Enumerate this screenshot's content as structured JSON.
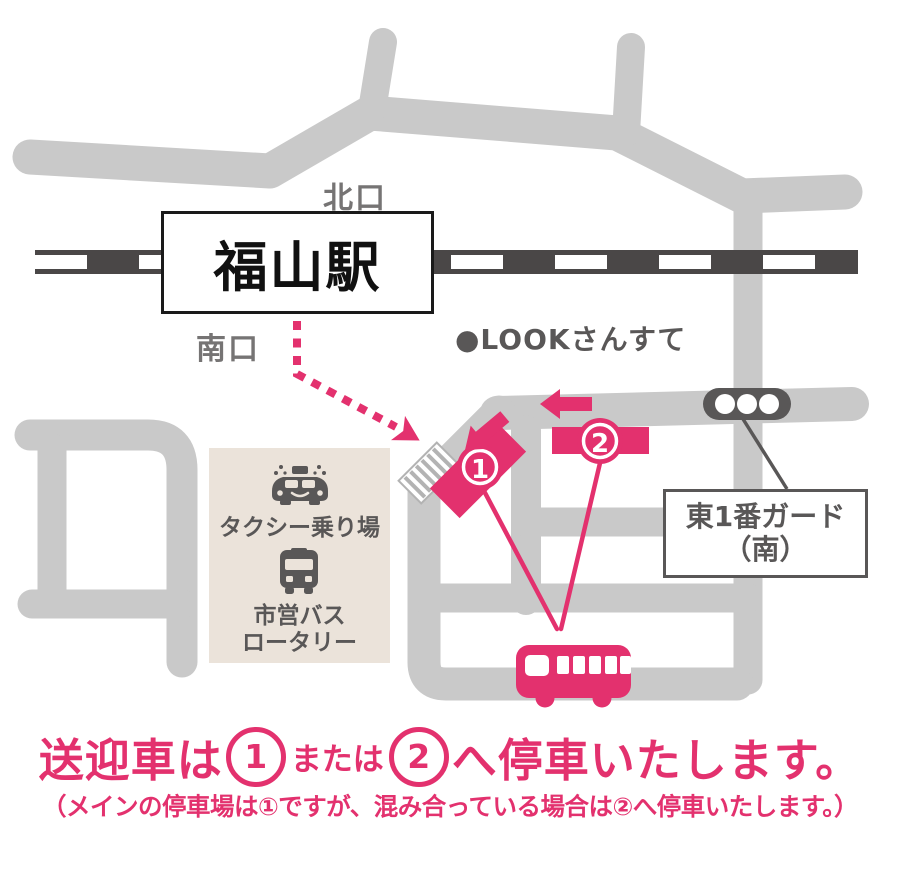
{
  "map": {
    "station": {
      "name": "福山駅",
      "north_exit": "北口",
      "south_exit": "南口"
    },
    "landmark_look": "●LOOKさんすて",
    "guard_label": {
      "line1": "東1番ガード",
      "line2": "（南）"
    },
    "terminal": {
      "taxi_stand": "タクシー乗り場",
      "bus_rotary_line1": "市営バス",
      "bus_rotary_line2": "ロータリー"
    },
    "markers": {
      "marker1": "1",
      "marker2": "2"
    }
  },
  "caption": {
    "main_prefix": "送迎車は",
    "main_num1": "1",
    "main_middle": "または",
    "main_num2": "2",
    "main_suffix": "へ停車いたします。",
    "sub": "（メインの停車場は①ですが、混み合っている場合は②へ停車いたします。）"
  },
  "colors": {
    "pink": "#e3316e",
    "road_gray": "#c9c9c9",
    "dark_gray": "#595757",
    "rail_dark": "#4a4747",
    "beige": "#ebe3da",
    "exit_text_gray": "#767474",
    "black": "#1a1a1a"
  }
}
